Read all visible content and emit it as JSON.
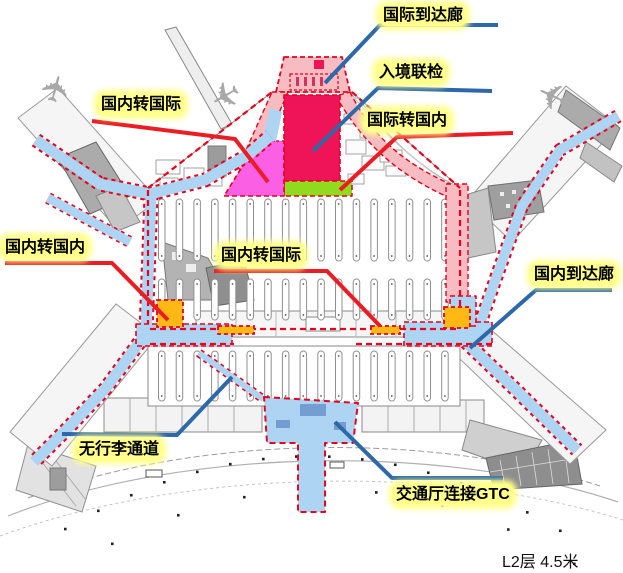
{
  "diagram": {
    "floor_note": "L2层 4.5米",
    "labels": {
      "intl_arrival": "国际到达廊",
      "immigration": "入境联检",
      "intl_to_domestic": "国际转国内",
      "domestic_to_intl_top": "国内转国际",
      "domestic_to_domestic": "国内转国内",
      "domestic_to_intl_center": "国内转国际",
      "domestic_arrival": "国内到达廊",
      "no_baggage": "无行李通道",
      "gtc_connection": "交通厅连接GTC"
    },
    "colors": {
      "corridor_blue": "#ADD4F2",
      "leader_blue": "#2D68A8",
      "leader_red": "#EC1C24",
      "boundary_red": "#E8001C",
      "zone_magenta": "#FB5FE3",
      "zone_crimson": "#EE1457",
      "zone_green": "#90DA20",
      "zone_salmon": "#F6BCC2",
      "transfer_node_orange": "#FFB814",
      "label_highlight": "#FFFF8C"
    }
  }
}
